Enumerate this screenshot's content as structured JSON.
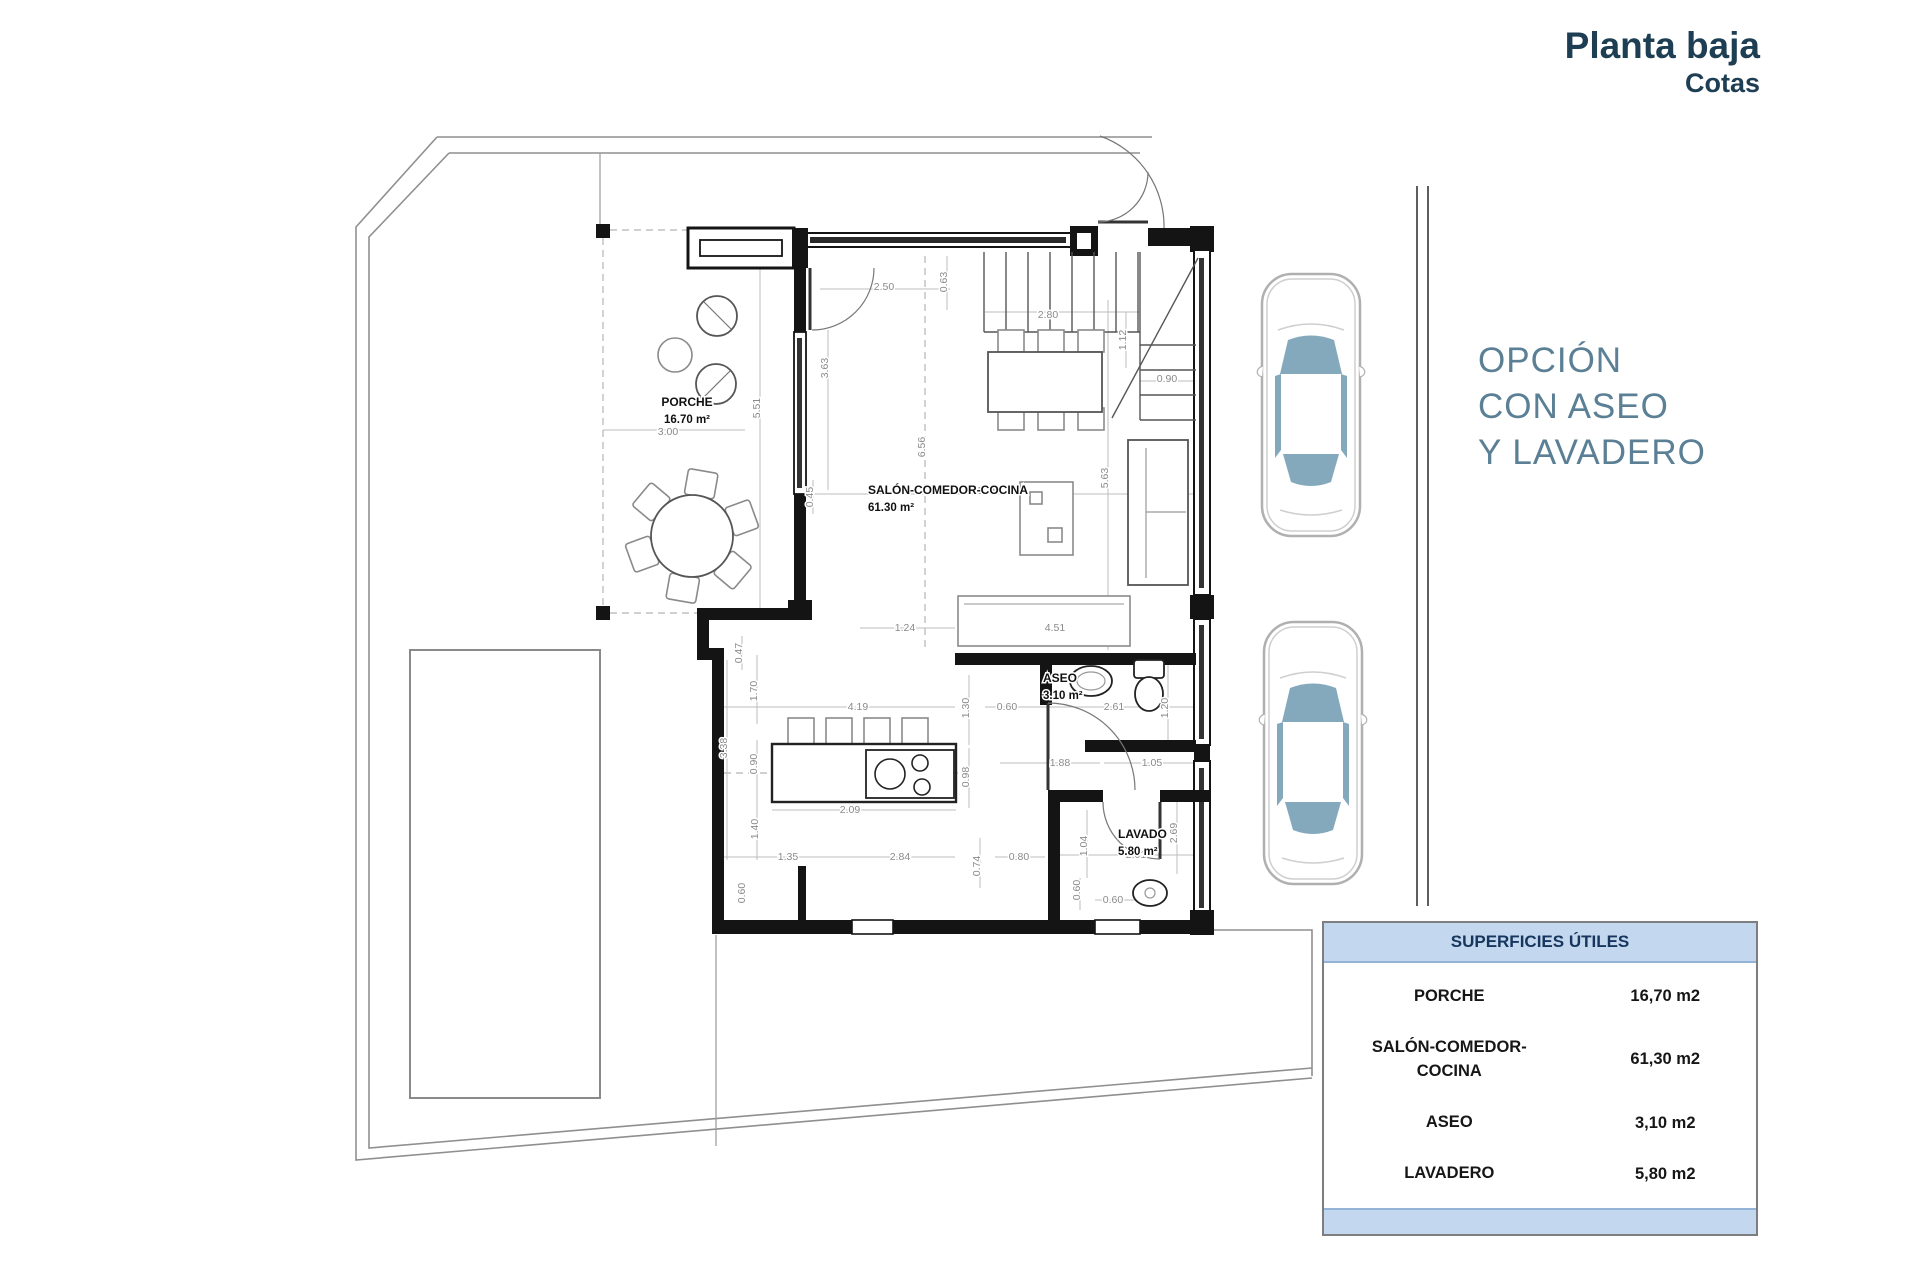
{
  "header": {
    "title": "Planta baja",
    "subtitle": "Cotas"
  },
  "option_note": {
    "lines": [
      "OPCIÓN",
      "CON ASEO",
      "Y LAVADERO"
    ]
  },
  "colors": {
    "title_text": "#1d3e53",
    "option_text": "#5b8095",
    "table_header_bg": "#c3d7ee",
    "table_accent_border": "#95b3d7",
    "car_glass": "#84a9bd",
    "wall": "#141414",
    "dim_text": "#8a8a8a"
  },
  "plan": {
    "rooms": [
      {
        "id": "porche",
        "name": "PORCHE",
        "area": "16.70 m²",
        "x": 687,
        "y": 406,
        "anchor": "middle"
      },
      {
        "id": "salon",
        "name": "SALÓN-COMEDOR-COCINA",
        "area": "61.30 m²",
        "x": 868,
        "y": 494,
        "anchor": "start"
      },
      {
        "id": "aseo",
        "name": "ASEO",
        "area": "3.10 m²",
        "x": 1043,
        "y": 682,
        "anchor": "start"
      },
      {
        "id": "lavado",
        "name": "LAVADO",
        "area": "5.80 m²",
        "x": 1118,
        "y": 838,
        "anchor": "start"
      }
    ],
    "dimensions": [
      {
        "v": "2.50",
        "x": 884,
        "y": 290,
        "r": 0
      },
      {
        "v": "0.63",
        "x": 947,
        "y": 282,
        "r": -90
      },
      {
        "v": "2.80",
        "x": 1048,
        "y": 318,
        "r": 0
      },
      {
        "v": "1.12",
        "x": 1126,
        "y": 340,
        "r": -90
      },
      {
        "v": "0.90",
        "x": 1167,
        "y": 382,
        "r": 0
      },
      {
        "v": "3.63",
        "x": 828,
        "y": 368,
        "r": -90
      },
      {
        "v": "5.51",
        "x": 760,
        "y": 408,
        "r": -90
      },
      {
        "v": "3.00",
        "x": 668,
        "y": 435,
        "r": 0
      },
      {
        "v": "6.56",
        "x": 925,
        "y": 447,
        "r": -90
      },
      {
        "v": "5.75",
        "x": 988,
        "y": 494,
        "r": 0
      },
      {
        "v": "5.63",
        "x": 1108,
        "y": 478,
        "r": -90
      },
      {
        "v": "0.45",
        "x": 813,
        "y": 497,
        "r": -90
      },
      {
        "v": "1.24",
        "x": 905,
        "y": 631,
        "r": 0
      },
      {
        "v": "4.51",
        "x": 1055,
        "y": 631,
        "r": 0
      },
      {
        "v": "0.47",
        "x": 742,
        "y": 653,
        "r": -90
      },
      {
        "v": "1.70",
        "x": 757,
        "y": 691,
        "r": -90
      },
      {
        "v": "4.19",
        "x": 858,
        "y": 710,
        "r": 0
      },
      {
        "v": "1.30",
        "x": 969,
        "y": 708,
        "r": -90
      },
      {
        "v": "0.60",
        "x": 1007,
        "y": 710,
        "r": 0
      },
      {
        "v": "2.61",
        "x": 1114,
        "y": 710,
        "r": 0
      },
      {
        "v": "1.20",
        "x": 1168,
        "y": 708,
        "r": -90
      },
      {
        "v": "3.38",
        "x": 727,
        "y": 748,
        "r": -90
      },
      {
        "v": "0.90",
        "x": 757,
        "y": 764,
        "r": -90
      },
      {
        "v": "0.98",
        "x": 969,
        "y": 777,
        "r": -90
      },
      {
        "v": "1.88",
        "x": 1060,
        "y": 766,
        "r": 0
      },
      {
        "v": "1.05",
        "x": 1152,
        "y": 766,
        "r": 0
      },
      {
        "v": "2.09",
        "x": 850,
        "y": 813,
        "r": 0
      },
      {
        "v": "1.40",
        "x": 758,
        "y": 829,
        "r": -90
      },
      {
        "v": "2.69",
        "x": 1177,
        "y": 833,
        "r": -90
      },
      {
        "v": "1.04",
        "x": 1087,
        "y": 846,
        "r": -90
      },
      {
        "v": "2.01",
        "x": 1136,
        "y": 858,
        "r": 0
      },
      {
        "v": "1.35",
        "x": 788,
        "y": 860,
        "r": 0
      },
      {
        "v": "2.84",
        "x": 900,
        "y": 860,
        "r": 0
      },
      {
        "v": "0.74",
        "x": 980,
        "y": 866,
        "r": -90
      },
      {
        "v": "0.80",
        "x": 1019,
        "y": 860,
        "r": 0
      },
      {
        "v": "0.60",
        "x": 745,
        "y": 893,
        "r": -90
      },
      {
        "v": "0.60",
        "x": 1080,
        "y": 890,
        "r": -90
      },
      {
        "v": "0.60",
        "x": 1113,
        "y": 903,
        "r": 0
      }
    ]
  },
  "summary_table": {
    "title": "SUPERFICIES ÚTILES",
    "rows": [
      {
        "label": "PORCHE",
        "label2": "",
        "value": "16,70 m2"
      },
      {
        "label": "SALÓN-COMEDOR-",
        "label2": "COCINA",
        "value": "61,30 m2"
      },
      {
        "label": "ASEO",
        "label2": "",
        "value": "3,10 m2"
      },
      {
        "label": "LAVADERO",
        "label2": "",
        "value": "5,80 m2"
      }
    ]
  }
}
